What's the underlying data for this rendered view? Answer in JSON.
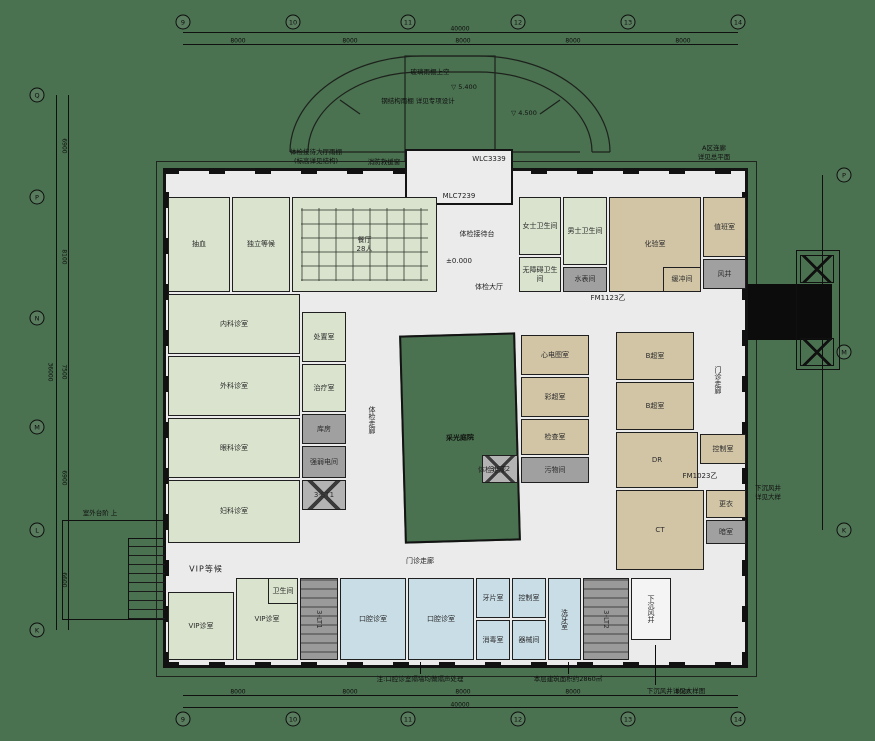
{
  "background": "#4a7150",
  "palette": {
    "room_green": "#d9e3cd",
    "room_tan": "#d2c5a6",
    "room_blue": "#c8dde6",
    "shaft_gray": "#a0a0a0",
    "floor": "#ebebeb",
    "wall": "#131313",
    "courtyard_green": "#4a7150"
  },
  "plan": {
    "rooms": [
      {
        "name": "抽血",
        "x": 168,
        "y": 197,
        "w": 62,
        "h": 95,
        "type": "green"
      },
      {
        "name": "独立等候",
        "x": 232,
        "y": 197,
        "w": 58,
        "h": 95,
        "type": "green"
      },
      {
        "name": "餐厅\n28人",
        "x": 292,
        "y": 197,
        "w": 145,
        "h": 95,
        "type": "green",
        "pattern": "tables"
      },
      {
        "name": "女士卫生间",
        "x": 519,
        "y": 197,
        "w": 42,
        "h": 58,
        "type": "green"
      },
      {
        "name": "无障碍卫生间",
        "x": 519,
        "y": 257,
        "w": 42,
        "h": 35,
        "type": "green"
      },
      {
        "name": "男士卫生间",
        "x": 563,
        "y": 197,
        "w": 44,
        "h": 68,
        "type": "green"
      },
      {
        "name": "水表间",
        "x": 563,
        "y": 267,
        "w": 44,
        "h": 25,
        "type": "gray"
      },
      {
        "name": "化验室",
        "x": 609,
        "y": 197,
        "w": 92,
        "h": 95,
        "type": "tan"
      },
      {
        "name": "缓冲间",
        "x": 663,
        "y": 267,
        "w": 38,
        "h": 25,
        "type": "tan"
      },
      {
        "name": "值班室",
        "x": 703,
        "y": 197,
        "w": 43,
        "h": 60,
        "type": "tan"
      },
      {
        "name": "风井",
        "x": 703,
        "y": 259,
        "w": 43,
        "h": 30,
        "type": "gray"
      },
      {
        "name": "内科诊室",
        "x": 168,
        "y": 294,
        "w": 132,
        "h": 60,
        "type": "green"
      },
      {
        "name": "外科诊室",
        "x": 168,
        "y": 356,
        "w": 132,
        "h": 60,
        "type": "green"
      },
      {
        "name": "眼科诊室",
        "x": 168,
        "y": 418,
        "w": 132,
        "h": 60,
        "type": "green"
      },
      {
        "name": "妇科诊室",
        "x": 168,
        "y": 480,
        "w": 132,
        "h": 63,
        "type": "green"
      },
      {
        "name": "处置室",
        "x": 302,
        "y": 312,
        "w": 44,
        "h": 50,
        "type": "green"
      },
      {
        "name": "治疗室",
        "x": 302,
        "y": 364,
        "w": 44,
        "h": 48,
        "type": "green"
      },
      {
        "name": "库房",
        "x": 302,
        "y": 414,
        "w": 44,
        "h": 30,
        "type": "gray"
      },
      {
        "name": "强弱电间",
        "x": 302,
        "y": 446,
        "w": 44,
        "h": 32,
        "type": "gray"
      },
      {
        "name": "3-ST1",
        "x": 302,
        "y": 480,
        "w": 44,
        "h": 30,
        "type": "elev"
      },
      {
        "name": "采光庭院",
        "x": 402,
        "y": 334,
        "w": 116,
        "h": 208,
        "type": "courtyard"
      },
      {
        "name": "心电图室",
        "x": 521,
        "y": 335,
        "w": 68,
        "h": 40,
        "type": "tan"
      },
      {
        "name": "彩超室",
        "x": 521,
        "y": 377,
        "w": 68,
        "h": 40,
        "type": "tan"
      },
      {
        "name": "检查室",
        "x": 521,
        "y": 419,
        "w": 68,
        "h": 36,
        "type": "tan"
      },
      {
        "name": "污物间",
        "x": 521,
        "y": 457,
        "w": 68,
        "h": 26,
        "type": "gray"
      },
      {
        "name": "3-ST2",
        "x": 482,
        "y": 455,
        "w": 36,
        "h": 28,
        "type": "elev"
      },
      {
        "name": "B超室",
        "x": 616,
        "y": 332,
        "w": 78,
        "h": 48,
        "type": "tan"
      },
      {
        "name": "B超室",
        "x": 616,
        "y": 382,
        "w": 78,
        "h": 48,
        "type": "tan"
      },
      {
        "name": "DR",
        "x": 616,
        "y": 432,
        "w": 82,
        "h": 56,
        "type": "tan"
      },
      {
        "name": "控制室",
        "x": 700,
        "y": 434,
        "w": 46,
        "h": 30,
        "type": "tan"
      },
      {
        "name": "CT",
        "x": 616,
        "y": 490,
        "w": 88,
        "h": 80,
        "type": "tan"
      },
      {
        "name": "更衣",
        "x": 706,
        "y": 490,
        "w": 40,
        "h": 28,
        "type": "tan"
      },
      {
        "name": "暗室",
        "x": 706,
        "y": 520,
        "w": 40,
        "h": 24,
        "type": "gray"
      },
      {
        "name": "VIP诊室",
        "x": 168,
        "y": 592,
        "w": 66,
        "h": 68,
        "type": "green"
      },
      {
        "name": "VIP诊室",
        "x": 236,
        "y": 578,
        "w": 62,
        "h": 82,
        "type": "green"
      },
      {
        "name": "卫生间",
        "x": 268,
        "y": 578,
        "w": 30,
        "h": 26,
        "type": "green"
      },
      {
        "name": "3-LT1",
        "x": 300,
        "y": 578,
        "w": 38,
        "h": 82,
        "type": "stair",
        "v": true
      },
      {
        "name": "口腔诊室",
        "x": 340,
        "y": 578,
        "w": 66,
        "h": 82,
        "type": "blue"
      },
      {
        "name": "口腔诊室",
        "x": 408,
        "y": 578,
        "w": 66,
        "h": 82,
        "type": "blue"
      },
      {
        "name": "牙片室",
        "x": 476,
        "y": 578,
        "w": 34,
        "h": 40,
        "type": "blue"
      },
      {
        "name": "控制室",
        "x": 512,
        "y": 578,
        "w": 34,
        "h": 40,
        "type": "blue"
      },
      {
        "name": "消毒室",
        "x": 476,
        "y": 620,
        "w": 34,
        "h": 40,
        "type": "blue"
      },
      {
        "name": "器械间",
        "x": 512,
        "y": 620,
        "w": 34,
        "h": 40,
        "type": "blue"
      },
      {
        "name": "洗牙室",
        "x": 548,
        "y": 578,
        "w": 33,
        "h": 82,
        "type": "blue",
        "v": true
      },
      {
        "name": "3-LT2",
        "x": 583,
        "y": 578,
        "w": 46,
        "h": 82,
        "type": "stair",
        "v": true
      },
      {
        "name": "下沉风井",
        "x": 631,
        "y": 578,
        "w": 40,
        "h": 62,
        "type": "white",
        "v": true
      }
    ],
    "labels": [
      {
        "t": "体检接待台",
        "x": 477,
        "y": 234
      },
      {
        "t": "±0.000",
        "x": 459,
        "y": 261
      },
      {
        "t": "体检大厅",
        "x": 489,
        "y": 287
      },
      {
        "t": "体检走廊",
        "x": 372,
        "y": 420,
        "cls": "vert"
      },
      {
        "t": "体检走廊",
        "x": 492,
        "y": 470
      },
      {
        "t": "门诊走廊",
        "x": 420,
        "y": 561
      },
      {
        "t": "门诊走廊",
        "x": 718,
        "y": 380,
        "cls": "vert"
      },
      {
        "t": "VIP等候",
        "x": 206,
        "y": 569,
        "cls": "big"
      },
      {
        "t": "MLC7239",
        "x": 459,
        "y": 196
      },
      {
        "t": "WLC3339",
        "x": 489,
        "y": 159
      },
      {
        "t": "FM1123乙",
        "x": 608,
        "y": 298
      },
      {
        "t": "FM1023乙",
        "x": 700,
        "y": 476
      }
    ],
    "annotations": [
      {
        "t": "消防救援窗",
        "x": 384,
        "y": 161
      },
      {
        "t": "体检接待大厅雨棚",
        "x": 316,
        "y": 151
      },
      {
        "t": "(标高详见结构)",
        "x": 316,
        "y": 160
      },
      {
        "t": "玻璃雨棚上空",
        "x": 430,
        "y": 71
      },
      {
        "t": "▽ 5.400",
        "x": 464,
        "y": 87
      },
      {
        "t": "钢结构雨棚 详见专项设计",
        "x": 418,
        "y": 100
      },
      {
        "t": "▽ 4.500",
        "x": 524,
        "y": 113
      },
      {
        "t": "A区连廊",
        "x": 714,
        "y": 147
      },
      {
        "t": "详见总平面",
        "x": 714,
        "y": 156
      },
      {
        "t": "下沉风井",
        "x": 768,
        "y": 487
      },
      {
        "t": "详见大样",
        "x": 768,
        "y": 496
      },
      {
        "t": "室外台阶 上",
        "x": 100,
        "y": 512
      },
      {
        "t": "注:口腔诊室隔墙均做隔声处理",
        "x": 420,
        "y": 678
      },
      {
        "t": "本层建筑面积约2860㎡",
        "x": 568,
        "y": 678
      },
      {
        "t": "下沉风井详见大样图",
        "x": 676,
        "y": 690
      }
    ],
    "grid": {
      "top": [
        {
          "l": "9",
          "x": 183,
          "y": 22
        },
        {
          "l": "10",
          "x": 293,
          "y": 22
        },
        {
          "l": "11",
          "x": 408,
          "y": 22
        },
        {
          "l": "12",
          "x": 518,
          "y": 22
        },
        {
          "l": "13",
          "x": 628,
          "y": 22
        },
        {
          "l": "14",
          "x": 738,
          "y": 22
        }
      ],
      "bottom": [
        {
          "l": "9",
          "x": 183,
          "y": 719
        },
        {
          "l": "10",
          "x": 293,
          "y": 719
        },
        {
          "l": "11",
          "x": 408,
          "y": 719
        },
        {
          "l": "12",
          "x": 518,
          "y": 719
        },
        {
          "l": "13",
          "x": 628,
          "y": 719
        },
        {
          "l": "14",
          "x": 738,
          "y": 719
        }
      ],
      "left": [
        {
          "l": "Q",
          "x": 37,
          "y": 95
        },
        {
          "l": "P",
          "x": 37,
          "y": 197
        },
        {
          "l": "N",
          "x": 37,
          "y": 318
        },
        {
          "l": "M",
          "x": 37,
          "y": 427
        },
        {
          "l": "L",
          "x": 37,
          "y": 530
        },
        {
          "l": "K",
          "x": 37,
          "y": 630
        }
      ],
      "right": [
        {
          "l": "P",
          "x": 844,
          "y": 175
        },
        {
          "l": "M",
          "x": 844,
          "y": 352
        },
        {
          "l": "K",
          "x": 844,
          "y": 530
        }
      ]
    },
    "dims": [
      {
        "t": "8000",
        "x": 238,
        "y": 41
      },
      {
        "t": "8000",
        "x": 350,
        "y": 41
      },
      {
        "t": "8000",
        "x": 463,
        "y": 41
      },
      {
        "t": "8000",
        "x": 573,
        "y": 41
      },
      {
        "t": "8000",
        "x": 683,
        "y": 41
      },
      {
        "t": "40000",
        "x": 460,
        "y": 29
      },
      {
        "t": "8000",
        "x": 238,
        "y": 692
      },
      {
        "t": "8000",
        "x": 350,
        "y": 692
      },
      {
        "t": "8000",
        "x": 463,
        "y": 692
      },
      {
        "t": "8000",
        "x": 573,
        "y": 692
      },
      {
        "t": "8000",
        "x": 683,
        "y": 692
      },
      {
        "t": "40000",
        "x": 460,
        "y": 705
      },
      {
        "t": "6900",
        "x": 64,
        "y": 146,
        "cls": "vert"
      },
      {
        "t": "8100",
        "x": 64,
        "y": 257,
        "cls": "vert"
      },
      {
        "t": "7500",
        "x": 64,
        "y": 372,
        "cls": "vert"
      },
      {
        "t": "6900",
        "x": 64,
        "y": 478,
        "cls": "vert"
      },
      {
        "t": "6600",
        "x": 64,
        "y": 580,
        "cls": "vert"
      },
      {
        "t": "36000",
        "x": 50,
        "y": 372,
        "cls": "vert"
      }
    ]
  }
}
